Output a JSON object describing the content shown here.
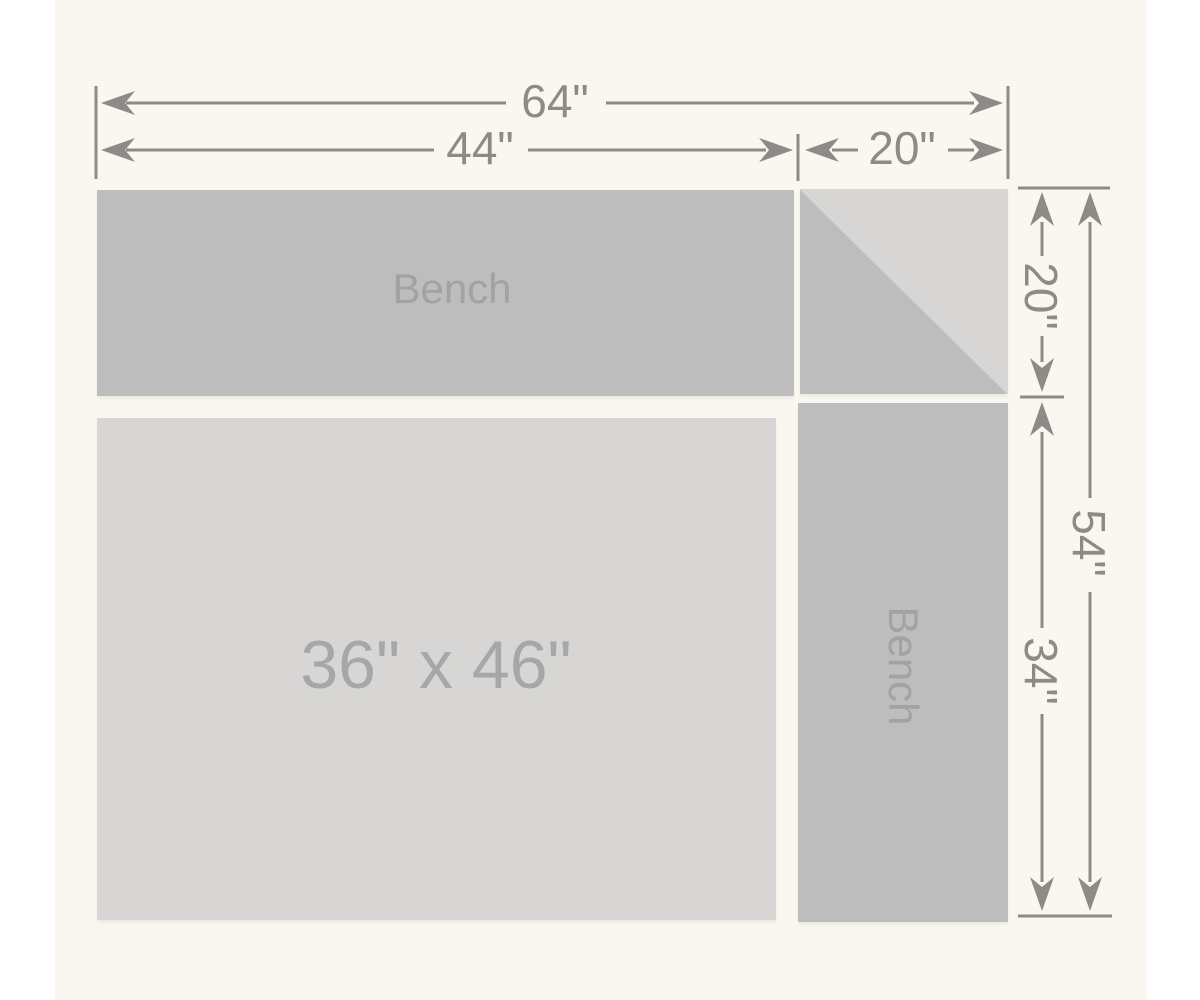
{
  "page": {
    "background": "#ffffff",
    "panel_background": "#faf6f0"
  },
  "colors": {
    "bench_fill": "#bdbdbd",
    "table_fill": "#d7d6d5",
    "corner_light_fill": "#d7d6d5",
    "dimension_color": "#8d8b88",
    "bench_label_color": "#a2a2a2",
    "table_label_color": "#a7a7a7"
  },
  "dimensions": {
    "total_width": "64\"",
    "bench_top_width": "44\"",
    "corner_width": "20\"",
    "corner_height": "20\"",
    "total_height": "54\"",
    "bench_right_height": "34\""
  },
  "shapes": {
    "bench_top": "Bench",
    "bench_right": "Bench",
    "table": "36\" x 46\""
  }
}
